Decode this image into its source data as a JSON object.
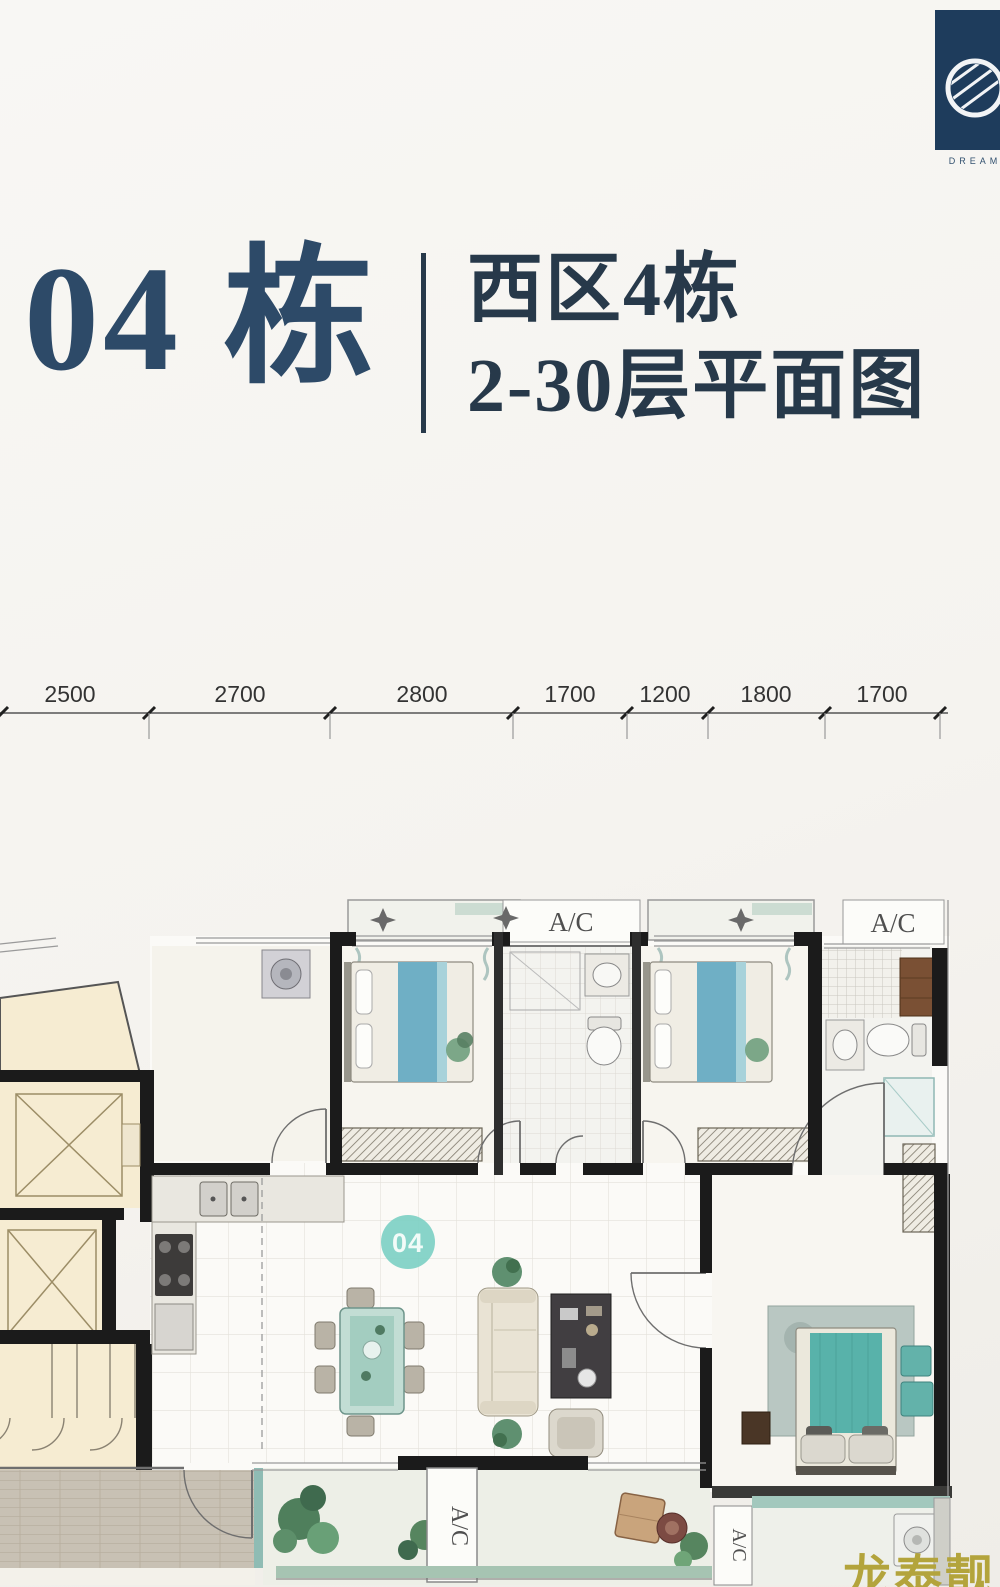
{
  "logo": {
    "text": "DREAM"
  },
  "header": {
    "building": "04 栋",
    "zone_line1": "西区4栋",
    "zone_line2": "2-30层平面图"
  },
  "dimensions": {
    "values": [
      "2500",
      "2700",
      "2800",
      "1700",
      "1200",
      "1800",
      "1700"
    ]
  },
  "plan": {
    "badge": "04",
    "ac_labels": [
      "A/C",
      "A/C",
      "A/C",
      "A/C"
    ]
  },
  "watermark": {
    "text": "龙泰靓房"
  },
  "colors": {
    "navy": "#2d4a68",
    "navy2": "#27394a",
    "wall": "#1b1b1b",
    "teal": "#7ed0c4",
    "bedblue": "#6fafc5",
    "masterteal": "#58b2aa",
    "cream": "#f6ecd2",
    "gold": "#b3a43c",
    "rail": "#a6c4b2",
    "dim": "#333333"
  }
}
